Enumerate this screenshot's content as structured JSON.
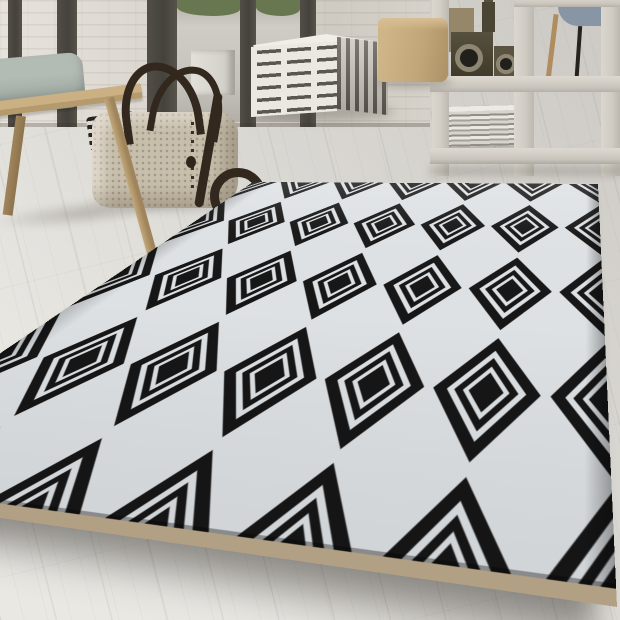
{
  "meta": {
    "description": "Interior product photo: black and white geometric diamond rug on light wood floor, wooden bench with pillow and woven duffel bag at left, striped cube pouf and tan pouf in center, white grid shelf room divider with wooden toy cameras and newspaper stack at right, white brick wall with dark floor-to-ceiling window frames and greenery outside"
  },
  "colors": {
    "floor_near": "#e9e8e3",
    "floor_far": "#ccc9c4",
    "wall": "#d8d3cb",
    "wall_light": "#e7e3dc",
    "frame": "#45423c",
    "glass": "#cfccc6",
    "greenery": "#68774f",
    "planter": "#e3e0d9",
    "bench_wood": "#cbb083",
    "bench_leg": "#a0855c",
    "pillow": "#97a29a",
    "bag_body": "#c8beac",
    "bag_strap": "#32281d",
    "pouf_white": "#ebe8e1",
    "pouf_stripe": "#5b564e",
    "pouf_side_light": "#cbc7be",
    "pouf_tan": "#c0a678",
    "shelf_bar": "#d0ccc3",
    "chair": "#8795a5",
    "wood_stick": "#b08d5f",
    "toy_dark": "#403a2c",
    "toy_ring": "#8d8673",
    "news_light": "#e8e7e2",
    "news_dark": "#918e86",
    "rug_black": "#161616",
    "rug_white": "#dde1e4",
    "rug_binding": "#b2a084"
  },
  "rug": {
    "label": "Black and white concentric diamond pattern area rug",
    "tile": 75,
    "cols": 6,
    "rows": 4,
    "ring_scales": [
      0.92,
      0.68,
      0.55,
      0.4,
      0.3
    ],
    "black": "#161616",
    "white": "#dde1e4"
  },
  "objects": {
    "rug": "diamond pattern rug",
    "bench": "wooden bench",
    "pillow": "grey-green cushion",
    "bag": "woven duffel bag with dark leather straps",
    "striped_pouf": "white pouf with dashed black stripes",
    "tan_pouf": "tan cube pouf",
    "shelf": "white grid shelf room divider",
    "toys": "wooden toy cameras",
    "newspapers": "stack of newspapers",
    "chair": "blue-grey chair behind shelf",
    "wall": "white painted brick wall with dark window frames"
  }
}
